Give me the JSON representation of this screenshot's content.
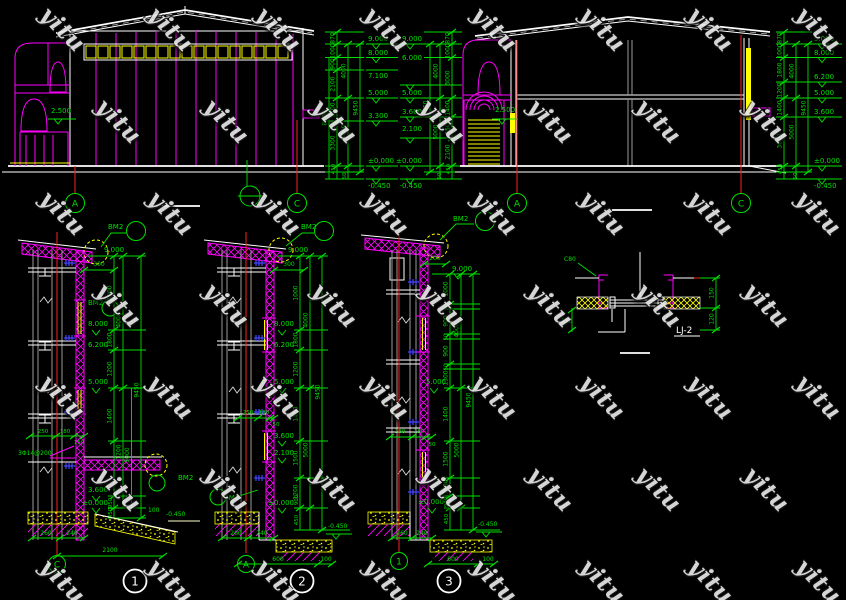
{
  "watermark": {
    "text": "yitu"
  },
  "colors": {
    "green": "#00e000",
    "magenta": "#ff00ff",
    "yellow": "#ffff00",
    "red": "#ff2020",
    "white": "#ffffff",
    "blue": "#4646ff"
  },
  "elevation": {
    "level": "2.500",
    "axis_a": "A",
    "axis_c": "C"
  },
  "section": {
    "level": "2.500",
    "axis_a": "A",
    "axis_c": "C"
  },
  "chain1": {
    "outer": "8500",
    "segs": [
      "870",
      "1000",
      "900",
      "2100",
      "1700",
      "3300"
    ],
    "mid": [
      "4000",
      "5000"
    ],
    "total": "9450",
    "base": [
      "450",
      "50"
    ],
    "levels": [
      "9.000",
      "8.000",
      "7.100",
      "5.000",
      "3.300",
      "±0.000",
      "-0.450"
    ]
  },
  "chain2": {
    "segs": [
      "870",
      "1000",
      "3000",
      "1400",
      "1500",
      "2100"
    ],
    "mid": [
      "4000",
      "5000"
    ],
    "total": "9450",
    "base": [
      "450",
      "50"
    ],
    "levels": [
      "9.000",
      "6.000",
      "5.000",
      "3.600",
      "2.100",
      "±0.000",
      "-0.450"
    ]
  },
  "chain3": {
    "segs": [
      "870",
      "1000",
      "1800",
      "1200",
      "1400",
      "3600"
    ],
    "mid": [
      "4000",
      "5000"
    ],
    "total": "9450",
    "base": [
      "450",
      "50"
    ],
    "levels": [
      "9.000",
      "8.000",
      "6.200",
      "5.000",
      "3.600",
      "±0.000",
      "-0.450"
    ]
  },
  "detail1": {
    "num": "1",
    "axis": "C",
    "bm2_top": "BM2",
    "bm2_mid": "BM2",
    "bm2_low": "BM2",
    "dim_300": "300",
    "upper": [
      "1000",
      "1800",
      "1200"
    ],
    "mid4000": "4000",
    "total": "9450",
    "low1": "1400",
    "low2": "1200",
    "mid5000": "5000",
    "dim_950": "950",
    "dim_450": "450",
    "levels": [
      "9.000",
      "8.000",
      "6.200",
      "5.000",
      "3.600",
      "±0.000"
    ],
    "level_base": "-0.450",
    "layers": [
      "250",
      "180",
      "150"
    ],
    "rebar": "3Φ14@200",
    "footing": [
      "260",
      "240"
    ],
    "dim_2100": "2100",
    "dim_100": "100"
  },
  "detail2": {
    "num": "2",
    "axis": "A",
    "bm2_top": "BM2",
    "bm2_low": "BM2",
    "dim_300": "300",
    "upper": [
      "1000",
      "1800",
      "1200"
    ],
    "mid4000": "4000",
    "total": "9450",
    "low": [
      "1400",
      "1500",
      "1200"
    ],
    "mid5000": "5000",
    "dim_900": "900",
    "dim_450": "450",
    "levels": [
      "9.000",
      "8.000",
      "6.200",
      "5.000",
      "3.600",
      "2.100",
      "±0.000"
    ],
    "level_base": "-0.450",
    "layers": [
      "250",
      "180",
      "50"
    ],
    "footing": [
      "260",
      "240"
    ],
    "dim_600": "600",
    "dim_100": "100"
  },
  "detail3": {
    "num": "3",
    "axis": "1",
    "bm2_top": "BM2",
    "dim_200": "200",
    "upper": [
      "1000",
      "900",
      "900",
      "1300"
    ],
    "tick50": "50",
    "mid4000": "4000",
    "total": "9450",
    "low": [
      "1400",
      "1500",
      "1300"
    ],
    "mid5000": "5000",
    "dim_900": "900",
    "dim_450": "450",
    "levels": [
      "9.000",
      "5.000",
      "±0.000"
    ],
    "level_base": "-0.450",
    "layers": [
      "230",
      "180",
      "50"
    ],
    "footing": [
      "260",
      "240"
    ],
    "dim_600": "600",
    "dim_100": "100"
  },
  "lj2": {
    "label": "LJ-2",
    "note": "C80",
    "dim_left": "150",
    "dim_r1": "150",
    "dim_r2": "120"
  }
}
